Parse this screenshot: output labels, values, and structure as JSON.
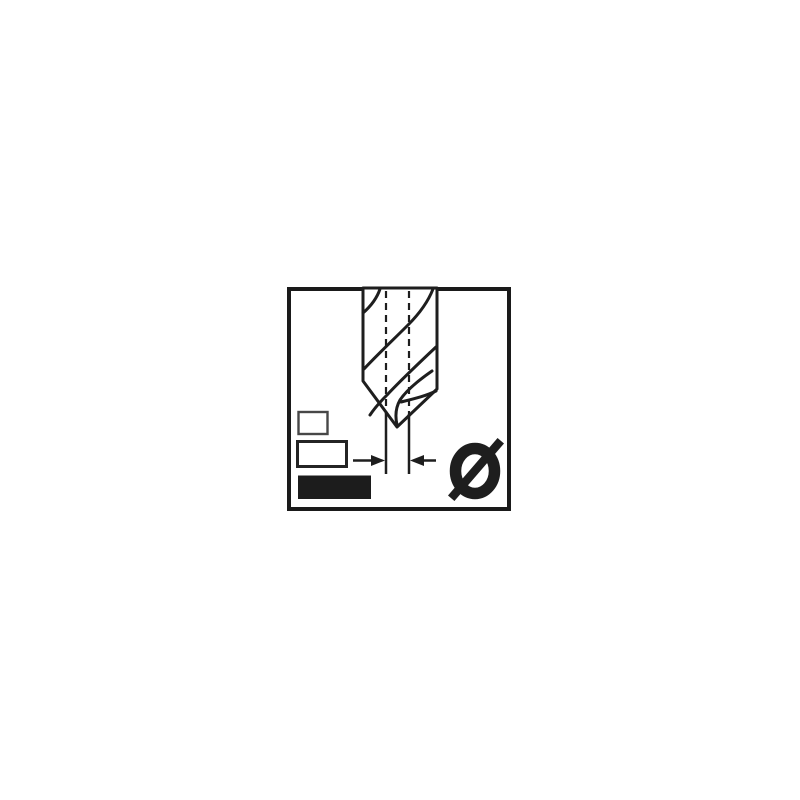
{
  "page": {
    "background": "#ffffff"
  },
  "pictogram": {
    "name": "drill-bit-point-diameter-pictogram",
    "diameter_symbol": "Ø",
    "colors": {
      "ink": "#1e1e1e",
      "frame": "#1a1a1a",
      "small_rect_border": "#474747",
      "medium_rect_border": "#242424",
      "filled_rect_fill": "#1c1c1c",
      "background": "#ffffff"
    }
  }
}
